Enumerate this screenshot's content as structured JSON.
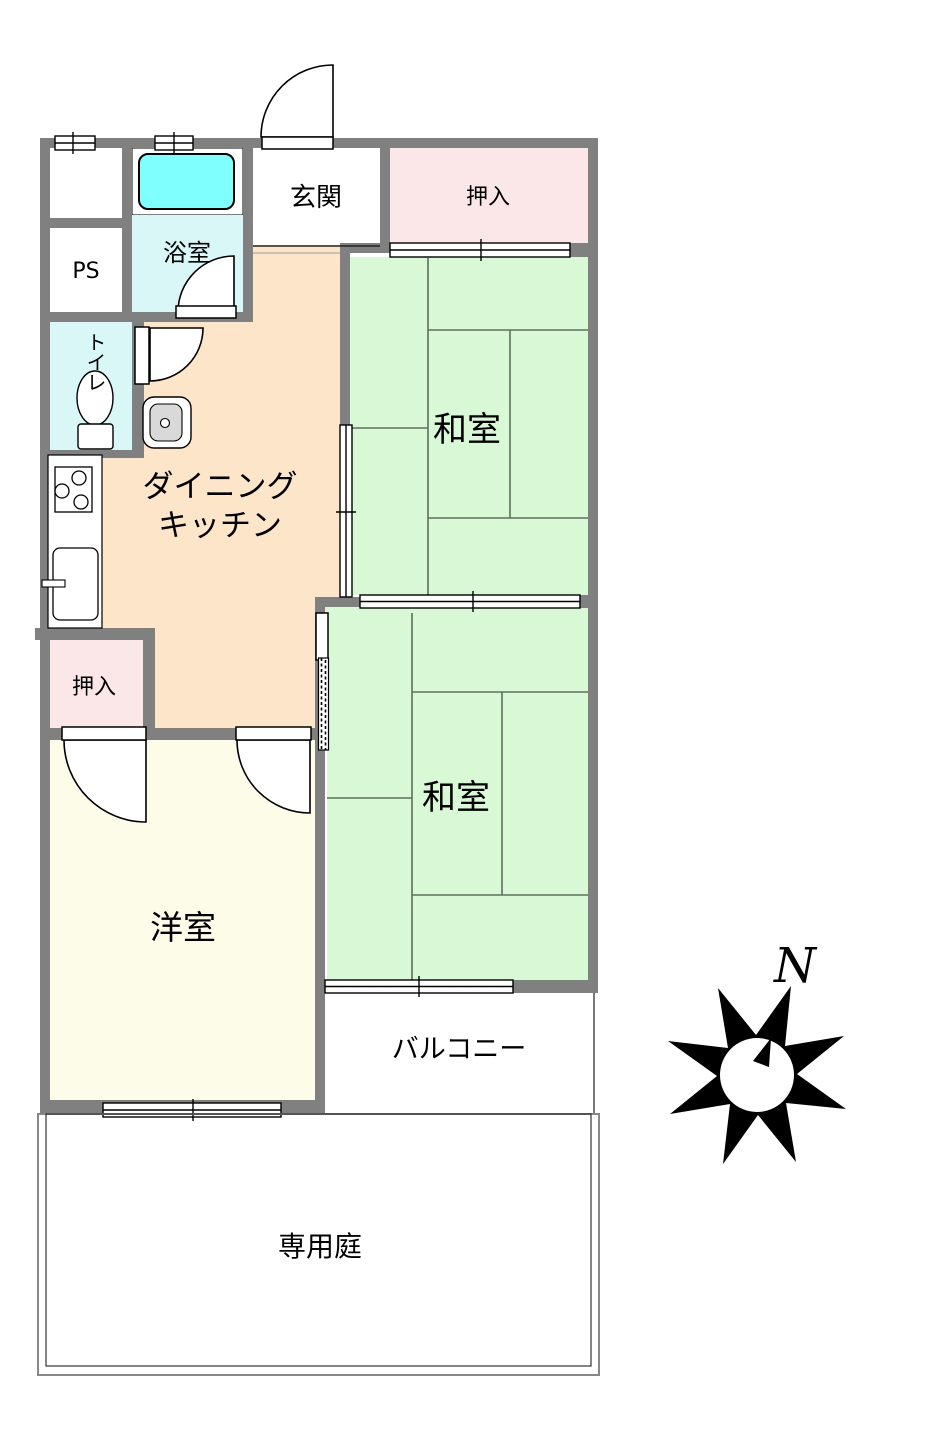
{
  "plan": {
    "title": "apartment-floor-plan",
    "labels": {
      "genkan": "玄関",
      "closet_top": "押入",
      "closet_bottom": "押入",
      "bath": "浴室",
      "toilet": "トイレ",
      "ps": "PS",
      "dk_line1": "ダイニング",
      "dk_line2": "キッチン",
      "washitsu_top": "和室",
      "washitsu_bottom": "和室",
      "yoshitsu": "洋室",
      "balcony": "バルコニー",
      "garden": "専用庭",
      "compass_north": "N"
    },
    "colors": {
      "wall": "#808080",
      "dining_kitchen": "#fde5c9",
      "washitsu": "#d8f8d6",
      "yoshitsu": "#fdfce8",
      "closet": "#fbe7e7",
      "wet_room": "#d9f7f7",
      "bathtub": "#80ffff",
      "tatami_line": "#5f6f5f",
      "fixture_gray": "#d9d9d9"
    }
  }
}
